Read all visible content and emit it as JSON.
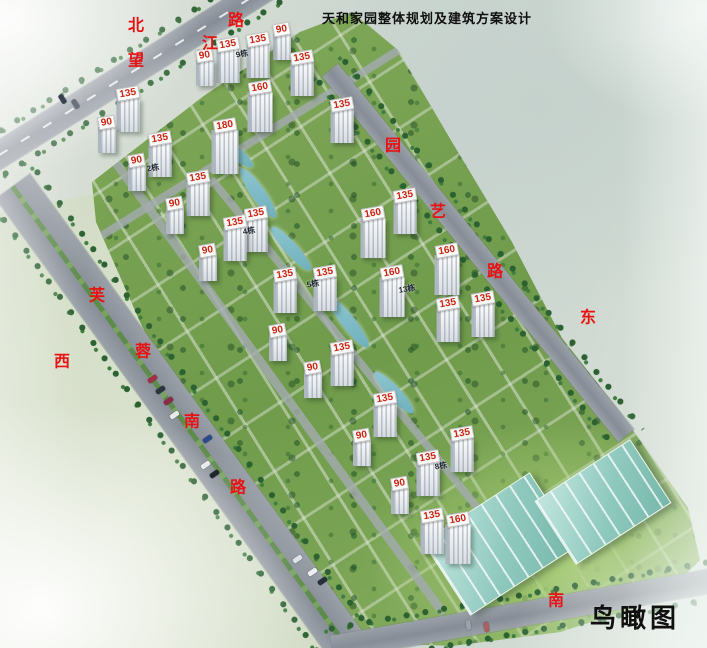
{
  "title": "天和家园整体规划及建筑方案设计",
  "view_label": "鸟瞰图",
  "colors": {
    "label_red": "#e81212",
    "number_red": "#cc2211",
    "title_black": "#101010",
    "road_grey": "#9299a2",
    "site_green": "#79a152",
    "roof_teal": "#a7d8cf"
  },
  "compass": [
    {
      "char": "北",
      "x": 136,
      "y": 26
    },
    {
      "char": "西",
      "x": 62,
      "y": 362
    },
    {
      "char": "东",
      "x": 588,
      "y": 318
    },
    {
      "char": "南",
      "x": 556,
      "y": 601
    }
  ],
  "roads": [
    {
      "name": "望江路",
      "chars": [
        {
          "c": "望",
          "x": 136,
          "y": 61
        },
        {
          "c": "江",
          "x": 210,
          "y": 44
        },
        {
          "c": "路",
          "x": 236,
          "y": 21
        }
      ]
    },
    {
      "name": "芙蓉南路",
      "chars": [
        {
          "c": "芙",
          "x": 97,
          "y": 296
        },
        {
          "c": "蓉",
          "x": 143,
          "y": 352
        },
        {
          "c": "南",
          "x": 192,
          "y": 422
        },
        {
          "c": "路",
          "x": 238,
          "y": 488
        }
      ]
    },
    {
      "name": "园艺路",
      "chars": [
        {
          "c": "园",
          "x": 393,
          "y": 146
        },
        {
          "c": "艺",
          "x": 438,
          "y": 212
        },
        {
          "c": "路",
          "x": 495,
          "y": 272
        }
      ]
    }
  ],
  "buildings": [
    {
      "x": 205,
      "y": 56,
      "v": "90"
    },
    {
      "x": 228,
      "y": 45,
      "v": "135"
    },
    {
      "x": 258,
      "y": 40,
      "v": "135"
    },
    {
      "x": 282,
      "y": 30,
      "v": "90"
    },
    {
      "x": 302,
      "y": 58,
      "v": "135"
    },
    {
      "x": 260,
      "y": 88,
      "v": "160"
    },
    {
      "x": 342,
      "y": 105,
      "v": "135"
    },
    {
      "x": 128,
      "y": 94,
      "v": "135"
    },
    {
      "x": 107,
      "y": 123,
      "v": "90"
    },
    {
      "x": 225,
      "y": 126,
      "v": "180"
    },
    {
      "x": 160,
      "y": 139,
      "v": "135"
    },
    {
      "x": 137,
      "y": 161,
      "v": "90"
    },
    {
      "x": 198,
      "y": 178,
      "v": "135"
    },
    {
      "x": 175,
      "y": 204,
      "v": "90"
    },
    {
      "x": 256,
      "y": 214,
      "v": "135"
    },
    {
      "x": 235,
      "y": 223,
      "v": "135"
    },
    {
      "x": 208,
      "y": 251,
      "v": "90"
    },
    {
      "x": 405,
      "y": 196,
      "v": "135"
    },
    {
      "x": 373,
      "y": 214,
      "v": "160"
    },
    {
      "x": 447,
      "y": 251,
      "v": "160"
    },
    {
      "x": 392,
      "y": 273,
      "v": "160"
    },
    {
      "x": 483,
      "y": 299,
      "v": "135"
    },
    {
      "x": 448,
      "y": 304,
      "v": "135"
    },
    {
      "x": 285,
      "y": 275,
      "v": "135"
    },
    {
      "x": 325,
      "y": 273,
      "v": "135"
    },
    {
      "x": 278,
      "y": 331,
      "v": "90"
    },
    {
      "x": 342,
      "y": 348,
      "v": "135"
    },
    {
      "x": 313,
      "y": 368,
      "v": "90"
    },
    {
      "x": 385,
      "y": 399,
      "v": "135"
    },
    {
      "x": 362,
      "y": 436,
      "v": "90"
    },
    {
      "x": 462,
      "y": 434,
      "v": "135"
    },
    {
      "x": 428,
      "y": 458,
      "v": "135"
    },
    {
      "x": 400,
      "y": 484,
      "v": "90"
    },
    {
      "x": 432,
      "y": 516,
      "v": "135"
    },
    {
      "x": 458,
      "y": 520,
      "v": "160"
    }
  ],
  "block_labels": [
    {
      "x": 242,
      "y": 54,
      "t": "9栋"
    },
    {
      "x": 153,
      "y": 168,
      "t": "2栋"
    },
    {
      "x": 249,
      "y": 231,
      "t": "4栋"
    },
    {
      "x": 313,
      "y": 284,
      "t": "5栋"
    },
    {
      "x": 407,
      "y": 289,
      "t": "13栋"
    },
    {
      "x": 441,
      "y": 466,
      "t": "8栋"
    }
  ],
  "cars": [
    {
      "x": 60,
      "y": 94,
      "c": "#3a4250",
      "r": -33
    },
    {
      "x": 73,
      "y": 99,
      "c": "#6a7280",
      "r": -33
    },
    {
      "x": 150,
      "y": 374,
      "c": "#a03048",
      "r": 55
    },
    {
      "x": 158,
      "y": 385,
      "c": "#2c3440",
      "r": 55
    },
    {
      "x": 166,
      "y": 396,
      "c": "#8d2b4b",
      "r": 55
    },
    {
      "x": 172,
      "y": 410,
      "c": "#e8eaec",
      "r": 55
    },
    {
      "x": 205,
      "y": 434,
      "c": "#2a4a8a",
      "r": 55
    },
    {
      "x": 203,
      "y": 460,
      "c": "#e8eaec",
      "r": 55
    },
    {
      "x": 212,
      "y": 469,
      "c": "#20262e",
      "r": 55
    },
    {
      "x": 295,
      "y": 554,
      "c": "#dfe3e6",
      "r": 55
    },
    {
      "x": 310,
      "y": 567,
      "c": "#eceff1",
      "r": 55
    },
    {
      "x": 320,
      "y": 576,
      "c": "#26303c",
      "r": 55
    },
    {
      "x": 466,
      "y": 620,
      "c": "#9aa4a8",
      "r": -10
    },
    {
      "x": 484,
      "y": 622,
      "c": "#a86060",
      "r": -10
    }
  ]
}
